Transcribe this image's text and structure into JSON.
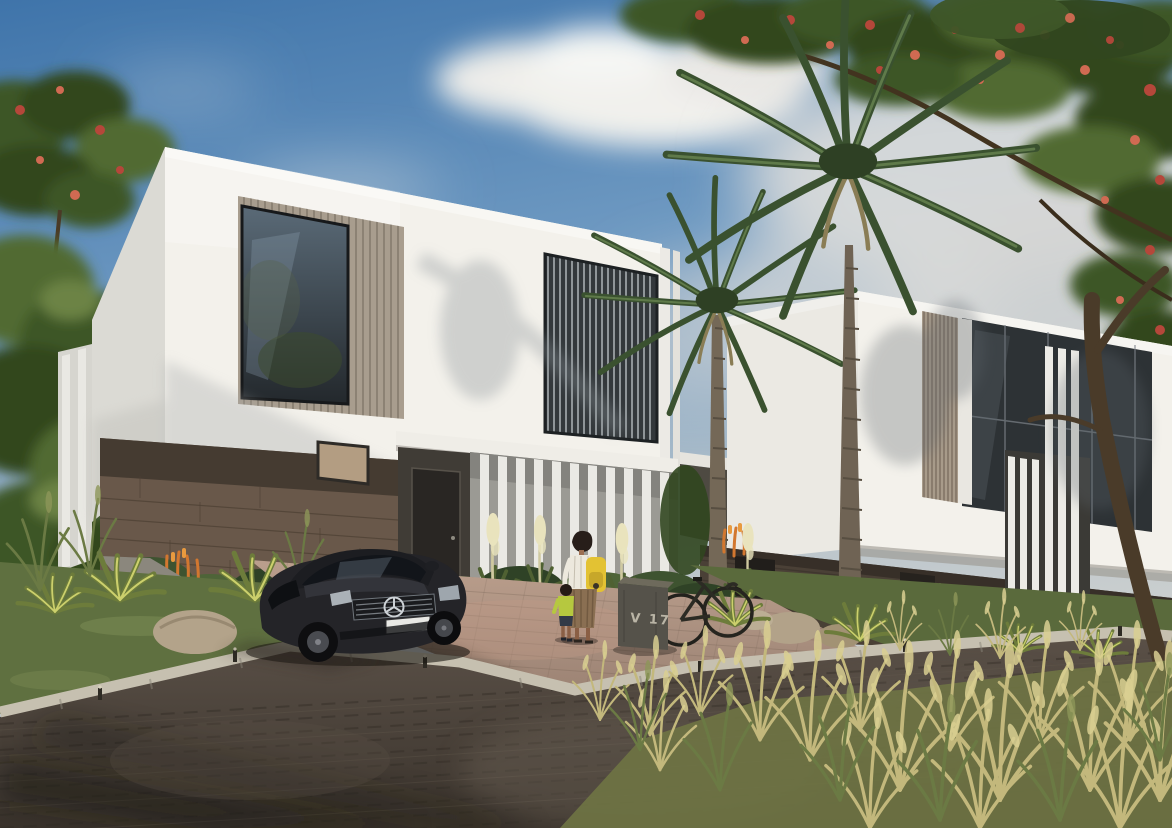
{
  "scene": {
    "type": "architectural-exterior-render",
    "description": "Photorealistic daytime rendering of a residential street with two modern two-storey villas: white upper volumes with wood-slat window surrounds and dark glazing, cantilevered over brown stone ground floors with white vertical fin screens. Tall date palms stand in front of the right villa; flame trees with red blossoms frame the top corners. A dark grey Mercedes sedan is parked in the driveway of the left villa, where a woman with a yellow backpack walks toward the entrance with a small child. A bicycle leans beside a stone marker engraved V 17. The foreground shows a brick-paved road, terracotta driveway, variegated agaves, rocks and tall golden ornamental grasses under a blue sky with white clouds.",
    "lighting": "bright sun from the left, long soft shadows",
    "objects": [
      "left villa: white upper floor, slatted window bays, stone plinth, dark entry door, white fin porch screen, small bronze window",
      "right villa: white upper floor, dark curtain-wall glazing, wood slat strip, vertical fins, dark stone plinth",
      "two tall date palms",
      "flame trees with red blossoms (top left and top right)",
      "dark grey Mercedes-Benz sedan with blank white license plate",
      "woman with dark curly hair, white top, striped brown skirt, yellow backpack",
      "small child in chartreuse shirt and dark shorts",
      "black bicycle",
      "stone villa marker engraved V 17",
      "yucca plants with cream bloom spikes",
      "variegated agave plants, boulders and rocks",
      "orange torch-lily flowers",
      "lawn verge, light concrete curb with small bollard lights",
      "terracotta brick driveway",
      "dark herringbone brick road",
      "tall golden ornamental grasses in the foreground",
      "blue sky with a large white cloud and hazy clouds"
    ]
  },
  "marker": {
    "label": "V 17"
  },
  "car": {
    "description": "dark grey sedan, three-quarter front view",
    "emblem": "Mercedes-Benz three-pointed star",
    "license_plate_text": ""
  },
  "people": [
    {
      "role": "woman",
      "details": "dark curly hair, white top, brown striped midi skirt, yellow backpack, walking away toward villa entrance"
    },
    {
      "role": "child",
      "details": "chartreuse top, dark shorts, holding close to the woman"
    }
  ],
  "palette": {
    "sky_top": "#3f74aa",
    "sky_horizon": "#d3d4d1",
    "cloud": "#f6f4ef",
    "villa_white": "#f3f1eb",
    "villa_shade": "#dbdad4",
    "wood_slat": "#a89d8e",
    "glass_dark": "#2d3235",
    "stone_brown": "#69584a",
    "stone_dark": "#4a4036",
    "lawn_green": "#5f7040",
    "agave_green": "#6d7c3b",
    "agave_edge": "#ccd06c",
    "palm_green": "#3a512f",
    "tree_green": "#3e5628",
    "flower_red": "#b5473a",
    "flower_orange": "#d2772f",
    "grass_gold": "#c3b87c",
    "curb": "#c6c0b0",
    "road_dark": "#474038",
    "driveway": "#b2977f",
    "rock_tan": "#b0a189",
    "car_body": "#242428",
    "plate_white": "#e9e9e5",
    "backpack_yellow": "#e3c233",
    "child_shirt": "#b6c83f",
    "skirt_brown": "#8a6f52",
    "marker_grey": "#55524a"
  }
}
